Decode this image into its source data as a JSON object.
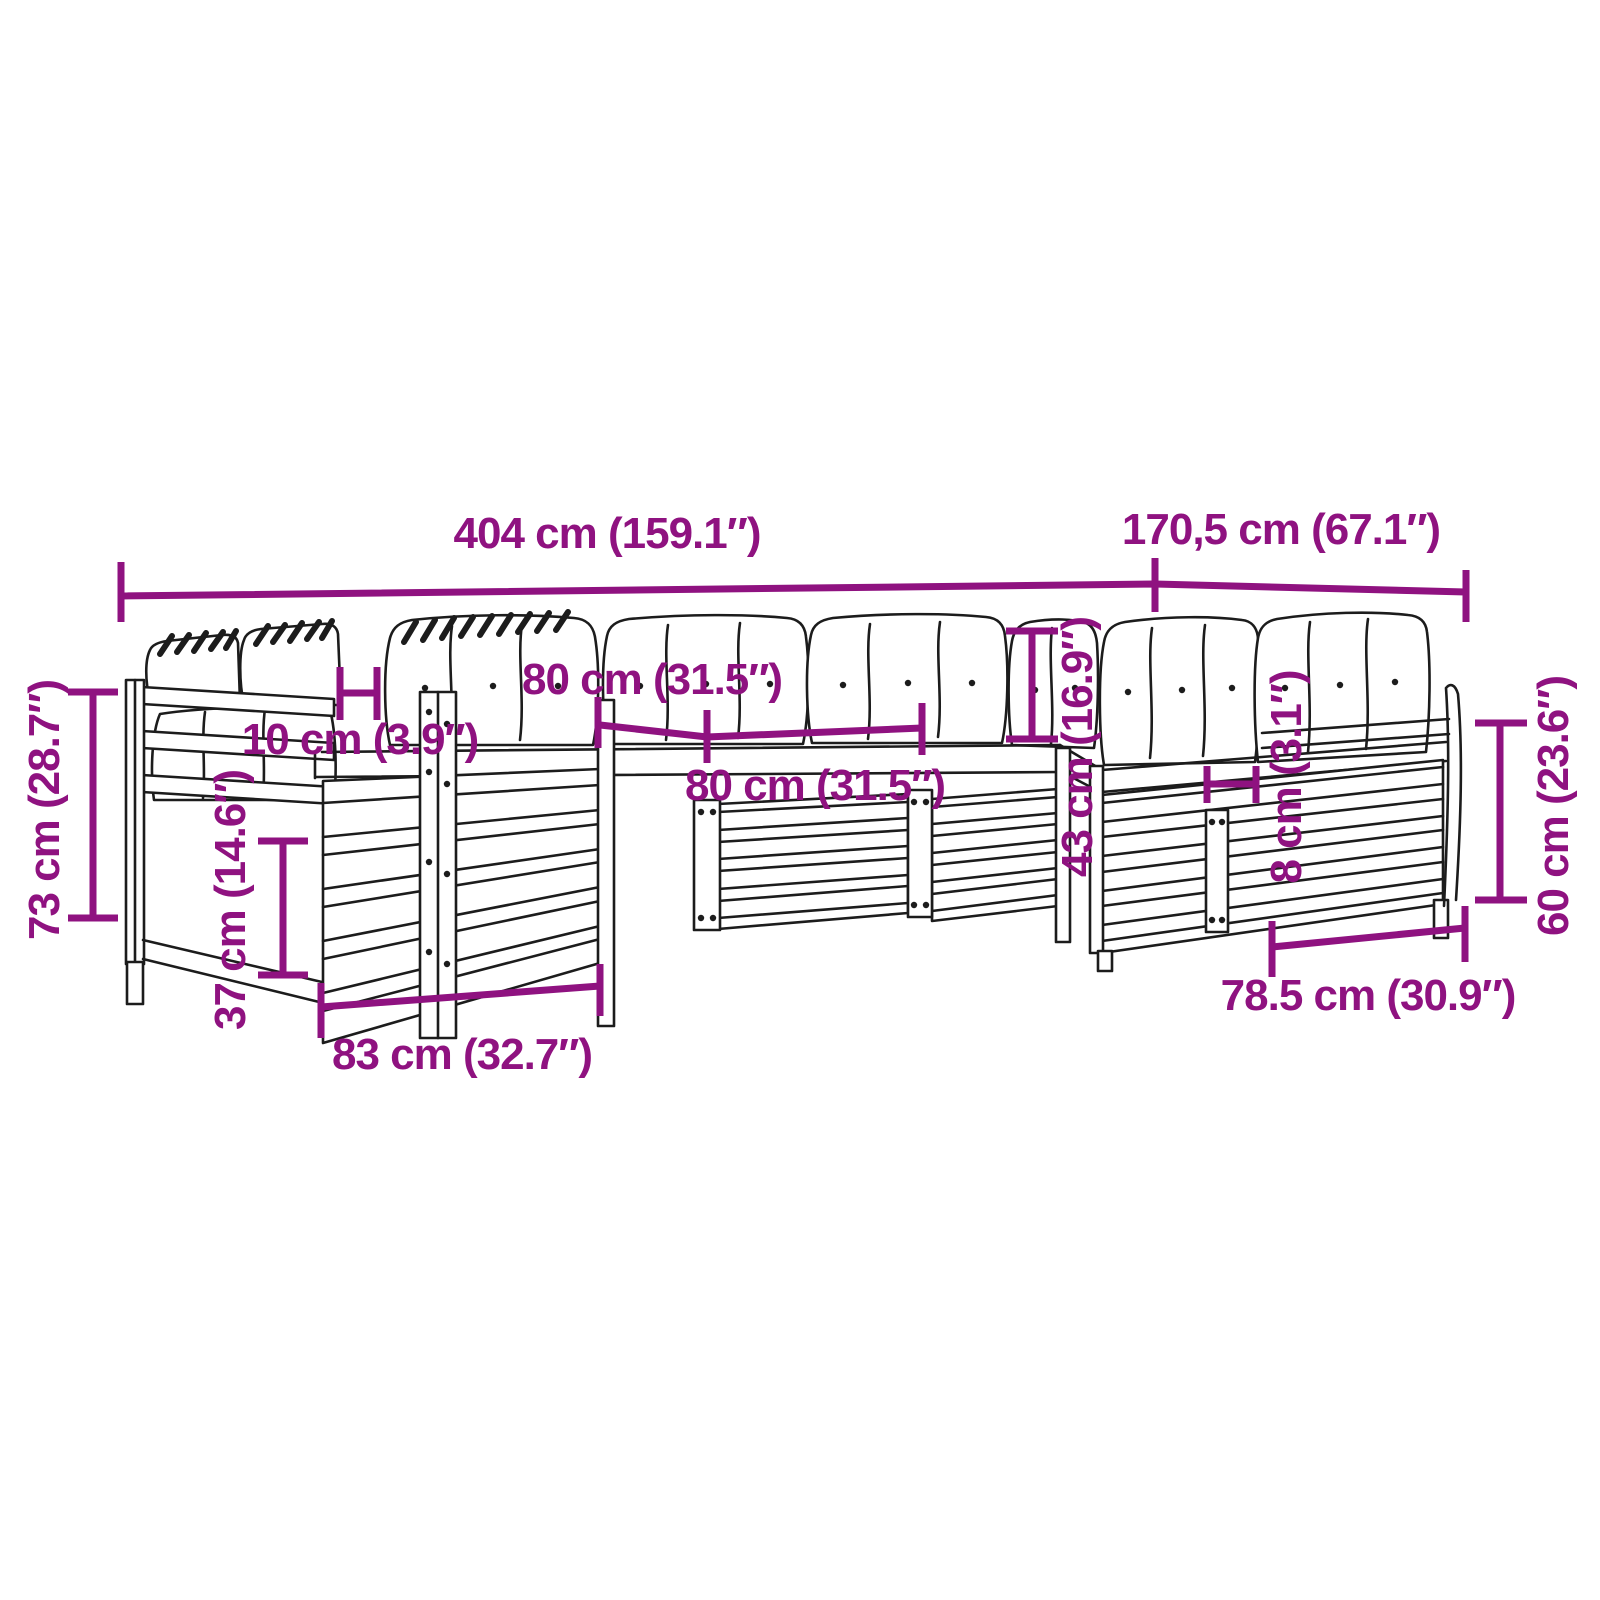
{
  "colors": {
    "accent": "#8F1280",
    "line_art": "#1c1c1c",
    "background": "#ffffff"
  },
  "diagram": {
    "type": "furniture-dimension-diagram",
    "subject": "garden-pallet-sofa-set-with-cushions"
  },
  "dimensions": {
    "total_width": "404 cm (159.1″)",
    "wing_depth": "170,5 cm (67.1″)",
    "total_height": "73 cm (28.7″)",
    "back_cushion_width": "80 cm (31.5″)",
    "seat_module_width": "80 cm (31.5″)",
    "armrest_top_width": "10 cm (3.9″)",
    "seat_height": "43 cm (16.9″)",
    "slat_width": "8 cm (3.1″)",
    "back_height": "60 cm (23.6″)",
    "seat_depth_left": "83 cm (32.7″)",
    "seat_depth_right": "78.5 cm (30.9″)",
    "base_height": "37 cm (14.6″)"
  }
}
